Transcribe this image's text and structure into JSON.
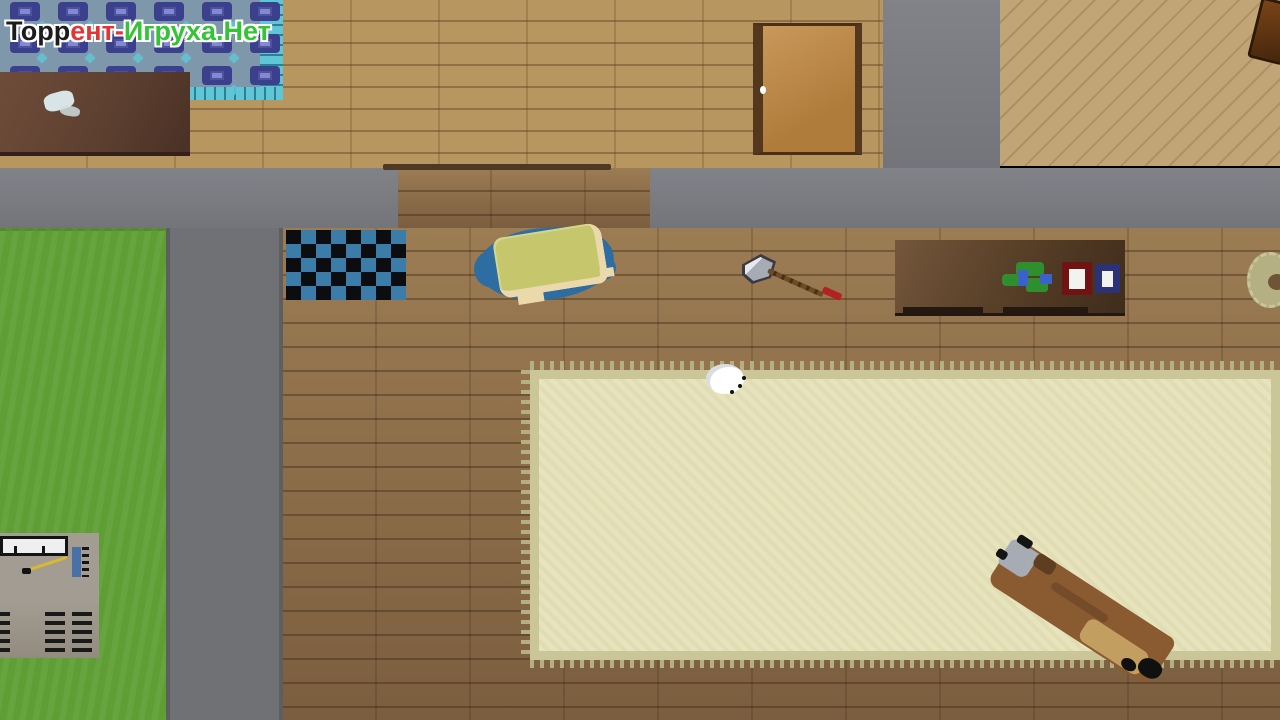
{
  "watermark": {
    "segments": [
      {
        "text": "Торр",
        "color": "#1c1c1c"
      },
      {
        "text": "ент-",
        "color": "#e23535"
      },
      {
        "text": "Игруха.Нет",
        "color": "#35c435"
      }
    ]
  },
  "scene": {
    "view": "top-down pixel-art house interior",
    "objects": [
      "blue-patterned-carpet",
      "wooden-table",
      "checkered-rug",
      "bed",
      "hand-axe",
      "writing-desk",
      "toy",
      "red-book",
      "navy-book",
      "door",
      "threshold",
      "large-beige-carpet",
      "white-egg",
      "bench-with-axe",
      "machine",
      "ring-item",
      "grass-lawn",
      "stone-path",
      "corner-furniture"
    ]
  },
  "colors": {
    "floor-hall": "#b8965f",
    "floor-main-top": "#9c7c53",
    "floor-main-bottom": "#7b5e3f",
    "floor-diag": "#c1a577",
    "wall": "#7b7c81",
    "road": "#6f7174",
    "road-edge": "#5c5e60",
    "grass": "#5f9e35",
    "carpet-field": "#e7e3bc",
    "carpet-border": "#cbc697",
    "carpet-tassel": "#b5b083",
    "rug-base": "#7e97ab",
    "rug-motif": "#3a3f8e",
    "rug-motif-inner": "#8288d8",
    "rug-cyan": "#5ec6d6",
    "checker-dark": "#0b0d11",
    "checker-blue": "#3c7ca8",
    "door-fill-a": "#c9985a",
    "door-fill-b": "#b07c3c",
    "door-frame": "#53381e",
    "threshold": "#4e3a24",
    "bed-blanket": "#2e6da1",
    "bed-mattress": "#c6c76c",
    "bed-edge": "#ecd9ab",
    "axe-metal": "#a7abb4",
    "axe-handle": "#6e4b28",
    "axe-red": "#b32222",
    "book-red": "#701315",
    "book-navy": "#2b3376",
    "book-pages": "#f2f2ee",
    "toy-green": "#2f8f2f",
    "toy-blue": "#3b62c8",
    "machine-body": "#a29c92",
    "machine-bar": "#efefef",
    "machine-blue": "#4a70a8",
    "cable-yellow": "#d9b92f",
    "vent-black": "#191919",
    "bench-wood": "#8a5a31",
    "bench-dark": "#5e3d20",
    "bench-tan": "#c7a465",
    "egg": "#ffffff"
  }
}
